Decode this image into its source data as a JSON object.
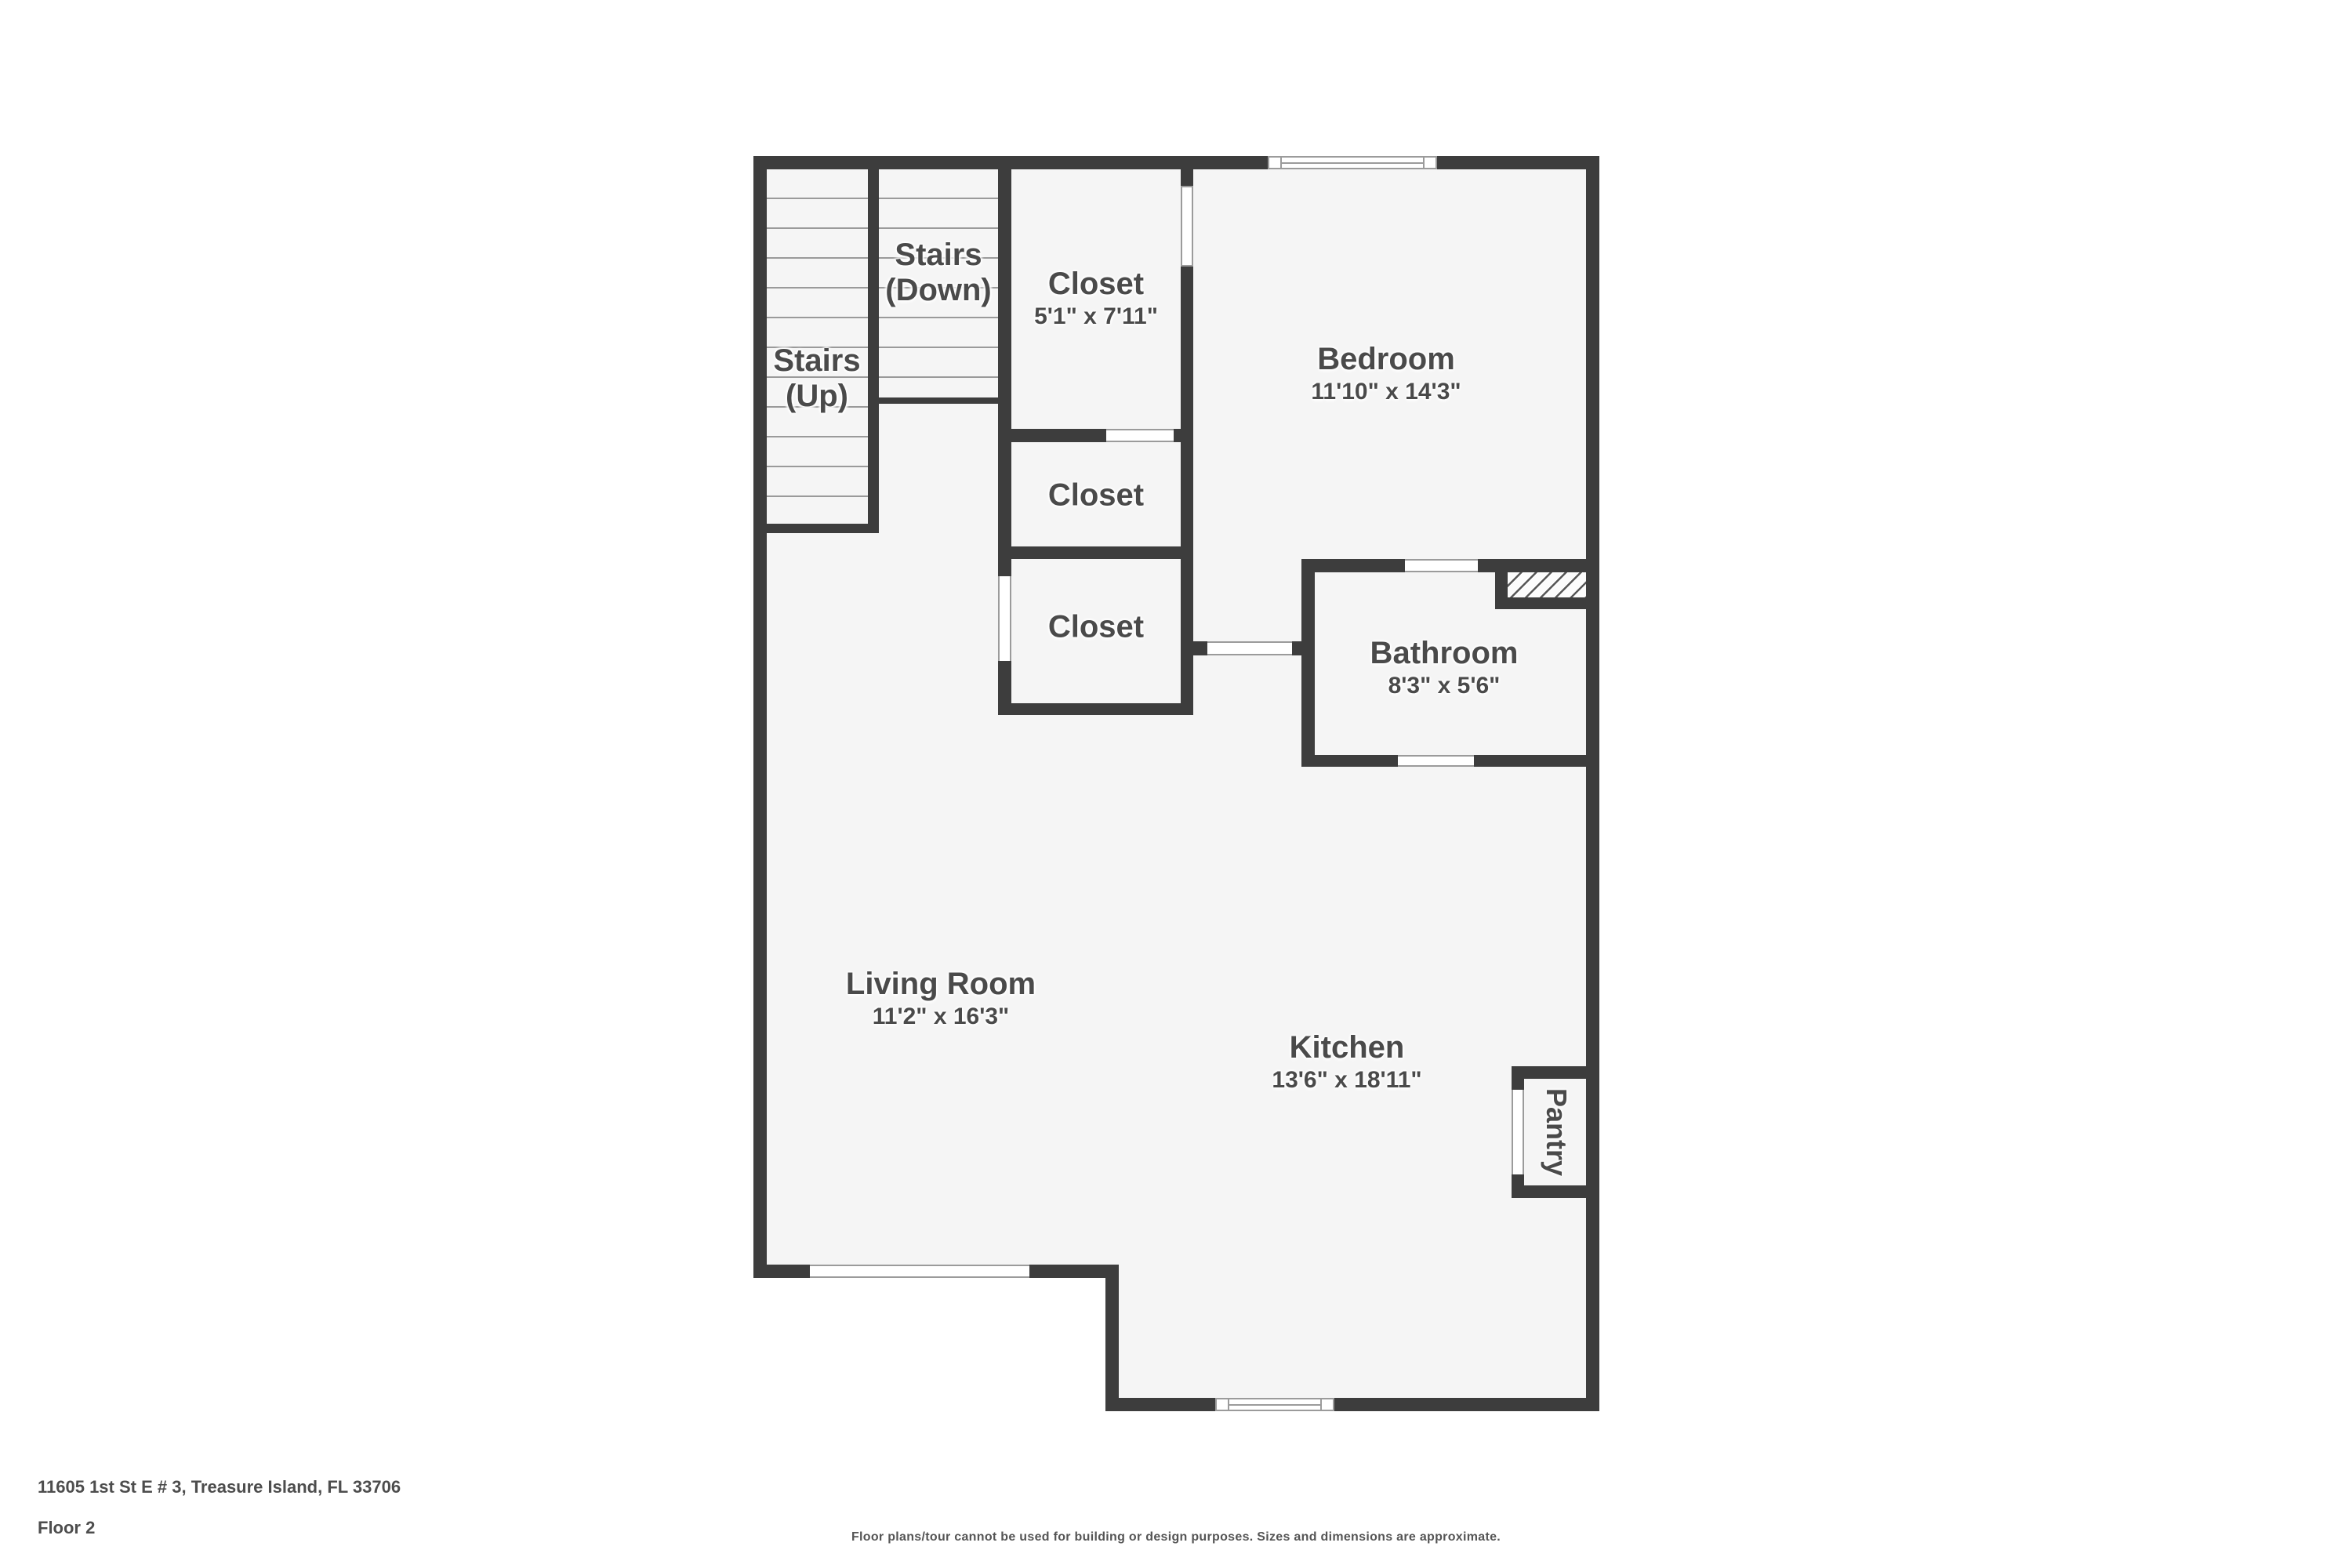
{
  "colors": {
    "wall": "#3d3d3d",
    "floor": "#f5f5f5",
    "outside": "#ffffff",
    "label_text": "#4a4a4a",
    "fixture_line": "#9b9b9b"
  },
  "rooms": {
    "stairs_up": {
      "label": "Stairs",
      "sub": "(Up)"
    },
    "stairs_down": {
      "label": "Stairs",
      "sub": "(Down)"
    },
    "closet_1": {
      "label": "Closet",
      "dims": "5'1\" x 7'11\""
    },
    "closet_2": {
      "label": "Closet"
    },
    "closet_3": {
      "label": "Closet"
    },
    "bedroom": {
      "label": "Bedroom",
      "dims": "11'10\" x 14'3\""
    },
    "bathroom": {
      "label": "Bathroom",
      "dims": "8'3\" x 5'6\""
    },
    "living_room": {
      "label": "Living Room",
      "dims": "11'2\" x 16'3\""
    },
    "kitchen": {
      "label": "Kitchen",
      "dims": "13'6\" x 18'11\""
    },
    "pantry": {
      "label": "Pantry"
    }
  },
  "footer": {
    "address": "11605 1st St E # 3, Treasure Island, FL 33706",
    "floor": "Floor 2",
    "disclaimer": "Floor plans/tour cannot be used for building or design purposes. Sizes and dimensions are approximate."
  }
}
